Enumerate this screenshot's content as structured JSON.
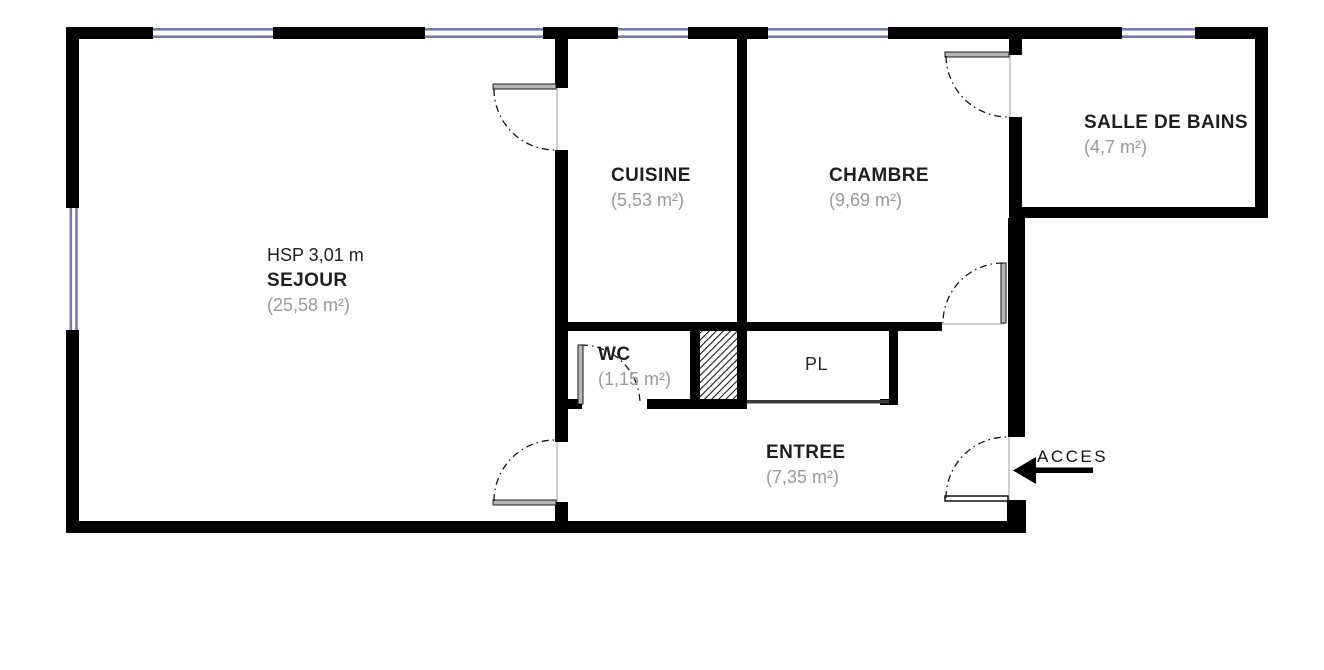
{
  "plan": {
    "rooms": [
      {
        "name": "SEJOUR",
        "area": "(25,58 m²)",
        "note": "HSP 3,01 m"
      },
      {
        "name": "CUISINE",
        "area": "(5,53 m²)"
      },
      {
        "name": "CHAMBRE",
        "area": "(9,69 m²)"
      },
      {
        "name": "SALLE DE BAINS",
        "area": "(4,7 m²)"
      },
      {
        "name": "WC",
        "area": "(1,15 m²)"
      },
      {
        "name": "PL"
      },
      {
        "name": "ENTREE",
        "area": "(7,35 m²)"
      }
    ],
    "access_label": "ACCES",
    "colors": {
      "wall": "#000000",
      "window": "#797bb0",
      "room_title": "#1f1f1f",
      "room_area": "#999999"
    }
  }
}
